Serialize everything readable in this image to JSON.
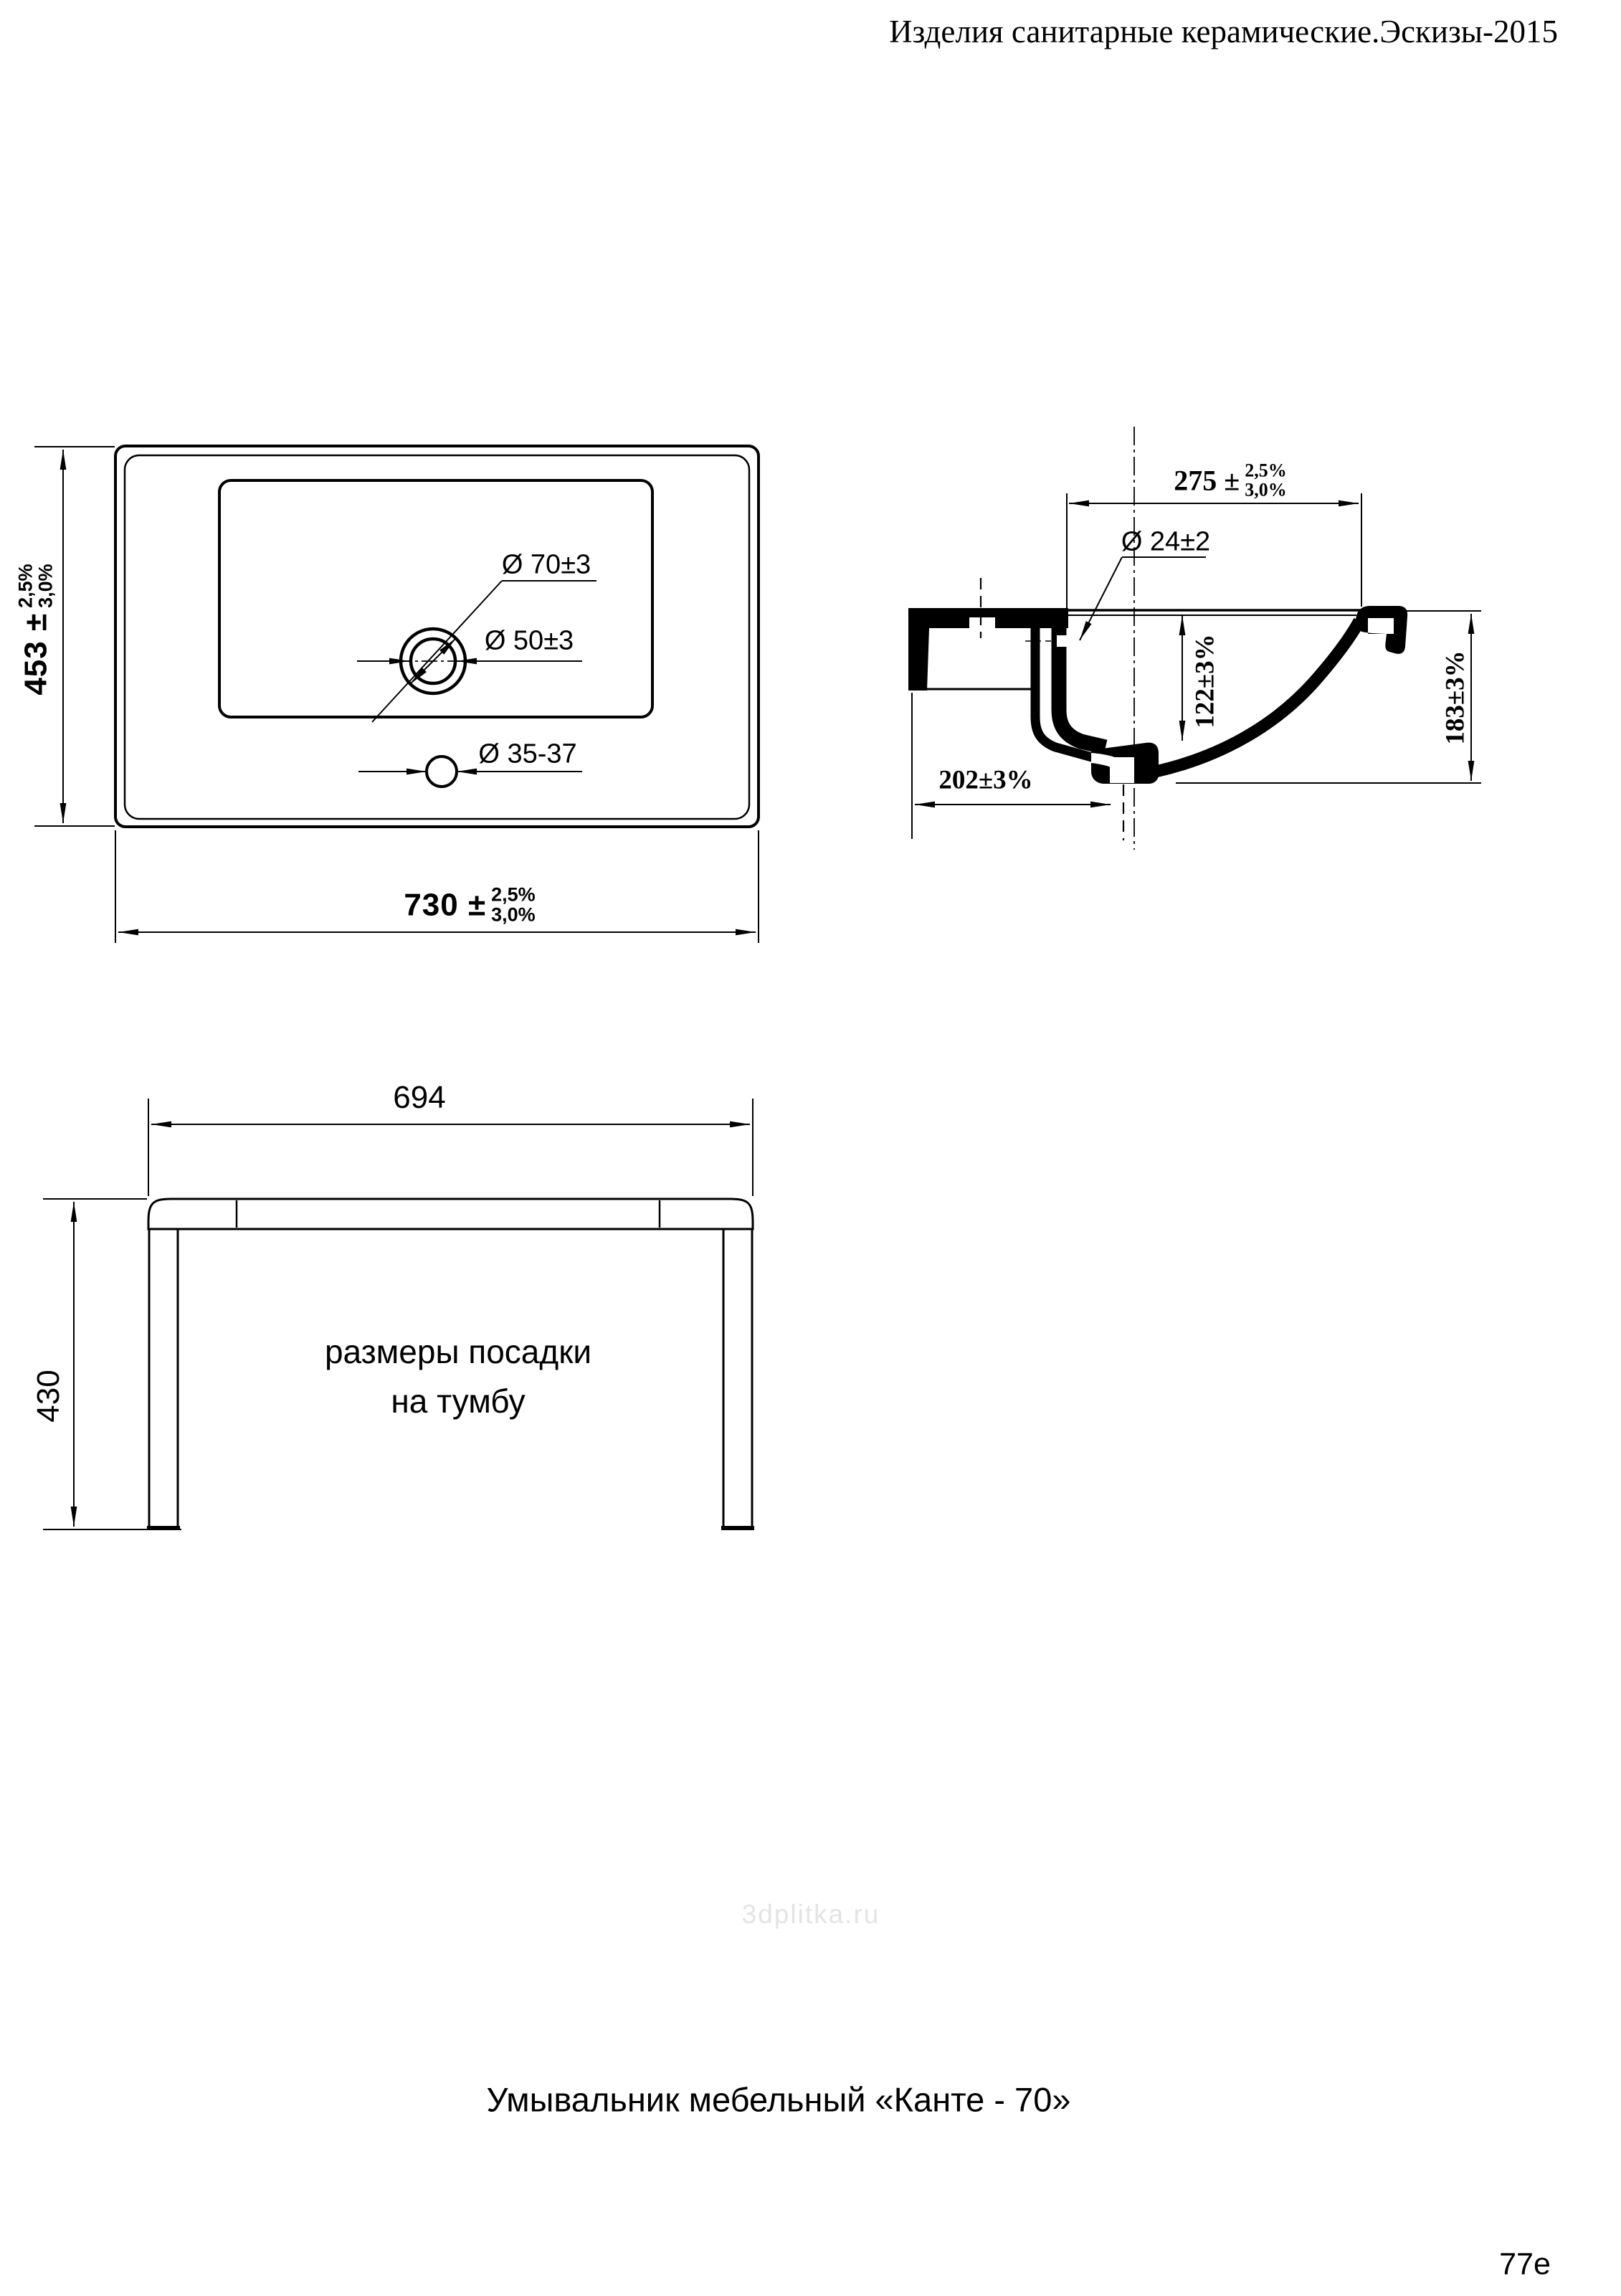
{
  "header": {
    "title": "Изделия санитарные керамические.Эскизы-2015"
  },
  "plan_view": {
    "height_dim": {
      "value": "453 ±",
      "tol_top": "2,5%",
      "tol_bottom": "3,0%"
    },
    "width_dim": {
      "value": "730 ±",
      "tol_top": "2,5%",
      "tol_bottom": "3,0%"
    },
    "faucet_hole_outer": "Ø 70±3",
    "faucet_hole_inner": "Ø 50±3",
    "overflow_hole": "Ø 35-37"
  },
  "section_view": {
    "front_dim": {
      "value": "275 ±",
      "tol_top": "2,5%",
      "tol_bottom": "3,0%"
    },
    "channel_hole": "Ø 24±2",
    "basin_depth": "122±3%",
    "overall_height": "183±3%",
    "drain_offset": "202±3%"
  },
  "mount_view": {
    "width": "694",
    "height": "430",
    "note_line1": "размеры посадки",
    "note_line2": "на тумбу"
  },
  "footer": {
    "caption": "Умывальник мебельный «Канте - 70»",
    "watermark": "3dplitka.ru",
    "page_number": "77e"
  }
}
